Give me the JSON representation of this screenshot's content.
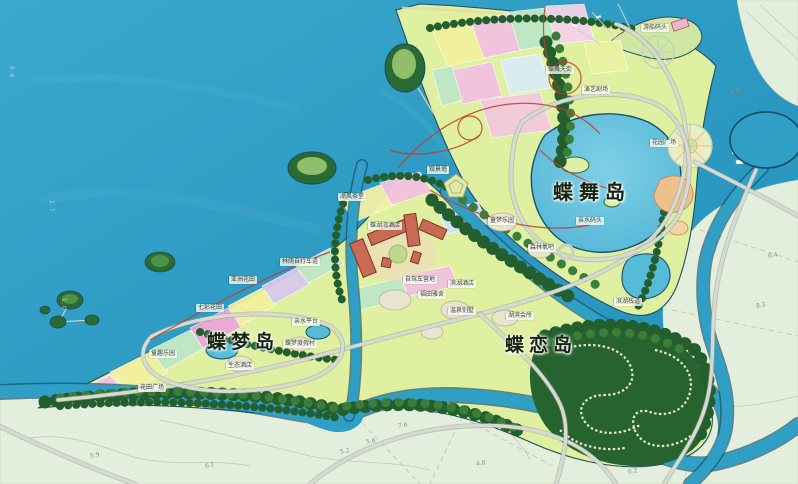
{
  "map": {
    "islands": [
      {
        "id": "diewu",
        "name": "蝶舞岛"
      },
      {
        "id": "diemeng",
        "name": "蝶梦岛"
      },
      {
        "id": "dielian",
        "name": "蝶恋岛"
      }
    ],
    "pois": [
      {
        "name": "凉风茶堂"
      },
      {
        "name": "蝶湖湾酒店"
      },
      {
        "name": "自驾车营地"
      },
      {
        "name": "滨湖酒店"
      },
      {
        "name": "林荫自行车道"
      },
      {
        "name": "亚洲花田"
      },
      {
        "name": "七彩花田"
      },
      {
        "name": "童趣乐园"
      },
      {
        "name": "花田广场"
      },
      {
        "name": "生态酒店"
      },
      {
        "name": "蝶梦度假村"
      },
      {
        "name": "亲水平台"
      },
      {
        "name": "温泉别墅"
      },
      {
        "name": "湖滨会所"
      },
      {
        "name": "福田雅舍"
      },
      {
        "name": "童梦乐园"
      },
      {
        "name": "森林氧吧"
      },
      {
        "name": "亲水码头"
      },
      {
        "name": "花园广场"
      },
      {
        "name": "游船码头"
      },
      {
        "name": "蝶舞天街"
      },
      {
        "name": "演艺剧场"
      },
      {
        "name": "观景塔"
      },
      {
        "name": "滨湖栈道"
      }
    ],
    "water_depths": [
      "0.8",
      "1.7",
      "1.0"
    ],
    "survey_numbers": [
      "5.9",
      "6.1",
      "5.2",
      "5.6",
      "7.6",
      "4.8",
      "6.2",
      "8.3",
      "4.5",
      "6.4"
    ],
    "colors": {
      "sea": "#2f9fc6",
      "seaDeep": "#1f8db4",
      "pale": "#e3efdc",
      "land": "#dff0a0",
      "forest": "#235e2e",
      "lake": "#58bedd",
      "road": "#d6dad2",
      "hotel": "#c96a54",
      "route": "#c23b2e"
    }
  }
}
